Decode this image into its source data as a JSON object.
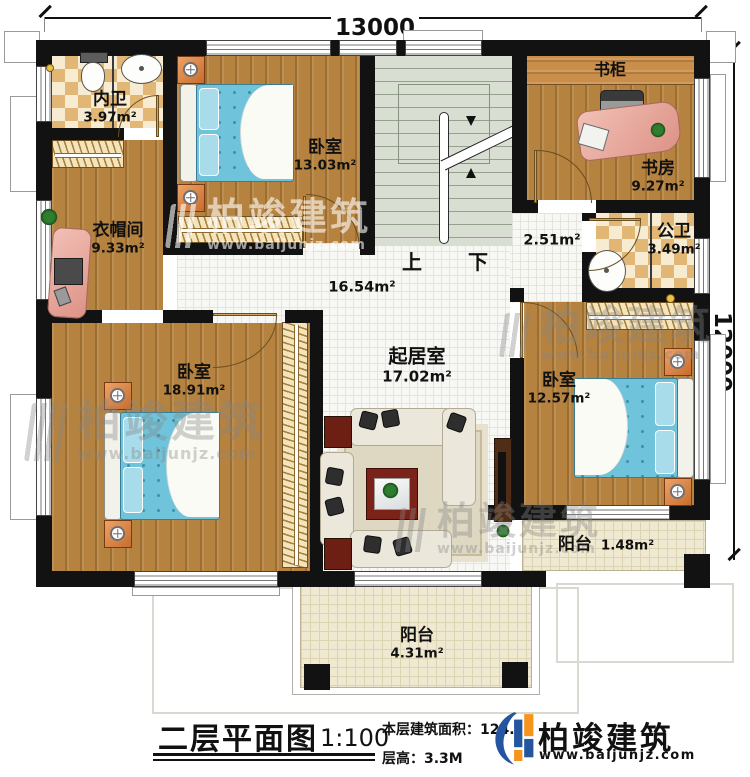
{
  "title_block": {
    "plan_title": "二层平面图",
    "scale": "1:100",
    "floor_area": "本层建筑面积：124.",
    "floor_height": "层高：3.3M"
  },
  "brand": {
    "name": "柏竣建筑",
    "url": "www.baijunjz.com"
  },
  "dimensions": {
    "width_mm": "13000",
    "height_mm": "12000"
  },
  "stairs": {
    "up": "上",
    "down": "下"
  },
  "rooms": {
    "ensuite_bath": {
      "name": "内卫",
      "area": "3.97m²"
    },
    "bedroom_top": {
      "name": "卧室",
      "area": "13.03m²"
    },
    "cloakroom": {
      "name": "衣帽间",
      "area": "9.33m²"
    },
    "bookcase": {
      "name": "书柜"
    },
    "study": {
      "name": "书房",
      "area": "9.27m²"
    },
    "public_bath": {
      "name": "公卫",
      "area": "3.49m²"
    },
    "hallway": {
      "area": "2.51m²"
    },
    "corridor": {
      "area": "16.54m²"
    },
    "living": {
      "name": "起居室",
      "area": "17.02m²"
    },
    "bedroom_left": {
      "name": "卧室",
      "area": "18.91m²"
    },
    "bedroom_right": {
      "name": "卧室",
      "area": "12.57m²"
    },
    "balcony_right": {
      "name": "阳台",
      "area": "1.48m²"
    },
    "balcony_bottom": {
      "name": "阳台",
      "area": "4.31m²"
    }
  },
  "colors": {
    "wall": "#121212",
    "wood": "#b5823f",
    "tile": "#f7f7f4",
    "checker_dark": "#e2b674",
    "stairs": "#d8ded1",
    "bed_blue": "#6fc3da",
    "balcony": "#efe9d2",
    "brand_blue": "#2456a0",
    "brand_orange": "#f7941d"
  }
}
